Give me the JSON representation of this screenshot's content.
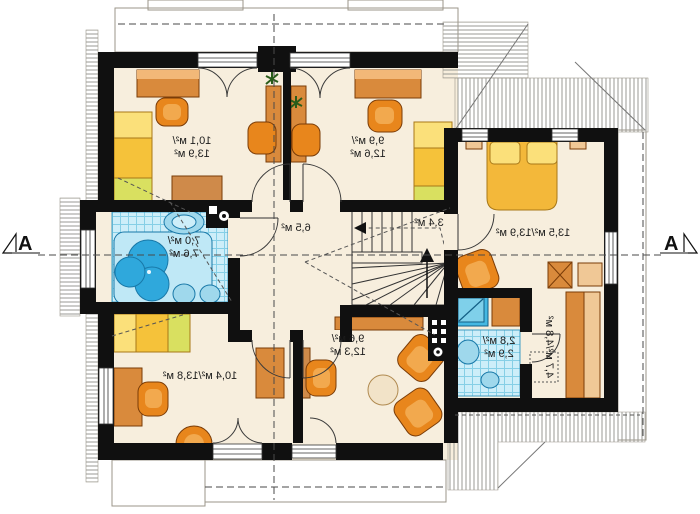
{
  "plan": {
    "type": "attic-floor-plan",
    "orientation": "mirrored",
    "section_markers": {
      "left": "A",
      "right": "A"
    },
    "rooms": [
      {
        "id": "bedroom-top-left",
        "area_label": "10,1 м²/13,9 м²",
        "lines": [
          "10,1 м²/",
          "13,9 м²"
        ]
      },
      {
        "id": "bedroom-top-middle",
        "area_label": "9,9 м²/12,6 м²",
        "lines": [
          "9,9 м²/",
          "12,6 м²"
        ]
      },
      {
        "id": "bedroom-right",
        "area_label": "13,5 м²/13,9 м²",
        "lines": [
          "13,5 м²/13,9 м²"
        ]
      },
      {
        "id": "bathroom",
        "area_label": "7,0 м²/7,6 м²",
        "lines": [
          "7,0 м²/",
          "7,6 м²"
        ]
      },
      {
        "id": "hall",
        "area_label": "6,5 м²",
        "lines": [
          "6,5 м²"
        ]
      },
      {
        "id": "staircase",
        "area_label": "3,4 м²",
        "lines": [
          "3,4 м²"
        ]
      },
      {
        "id": "bedroom-bottom-left",
        "area_label": "10,4 м²/13,8 м²",
        "lines": [
          "10,4 м²/13,8 м²"
        ]
      },
      {
        "id": "room-bottom-middle",
        "area_label": "9,6 м²/12,3 м²",
        "lines": [
          "9,6 м²/",
          "12,3 м²"
        ]
      },
      {
        "id": "shower-room",
        "area_label": "2,8 м²/2,9 м²",
        "lines": [
          "2,8 м²/",
          "2,9 м²"
        ]
      },
      {
        "id": "dressing-corridor",
        "area_label": "4,7 м²/4,8 м²",
        "lines": [
          "4,7 м²/4,8 м²"
        ]
      }
    ],
    "colors": {
      "floor": "#f7eedd",
      "wall": "#101010",
      "tile_floor": "#cdeef9",
      "tile_grid": "#86cfe6",
      "bathtub_blue": "#2fa8dc",
      "furniture_orange": "#e0862c",
      "furniture_orange_light": "#f2b878",
      "bed_yellow": "#f5c23a",
      "bed_pillow": "#fbe07a",
      "bed_green": "#d9e060",
      "hatch_line": "#9a9a94"
    }
  }
}
